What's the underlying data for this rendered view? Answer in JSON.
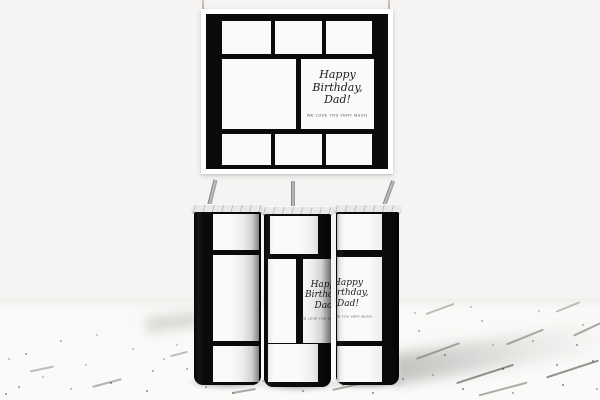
{
  "design": {
    "message_line1": "Happy",
    "message_line2": "Birthday,",
    "message_line3": "Dad!",
    "message_subtext": "WE LOVE YOU VERY MUCH"
  },
  "colors": {
    "wrap_black": "#0b0b0b",
    "panel_white": "#fafaf9",
    "card_white": "#ffffff",
    "wall_gray": "#f5f4f2",
    "floor_white": "#fbfaf9",
    "straw_metal": "#8f8f8f",
    "lid_clear": "#e9e9e7",
    "string_tan": "#cfc8bc"
  }
}
